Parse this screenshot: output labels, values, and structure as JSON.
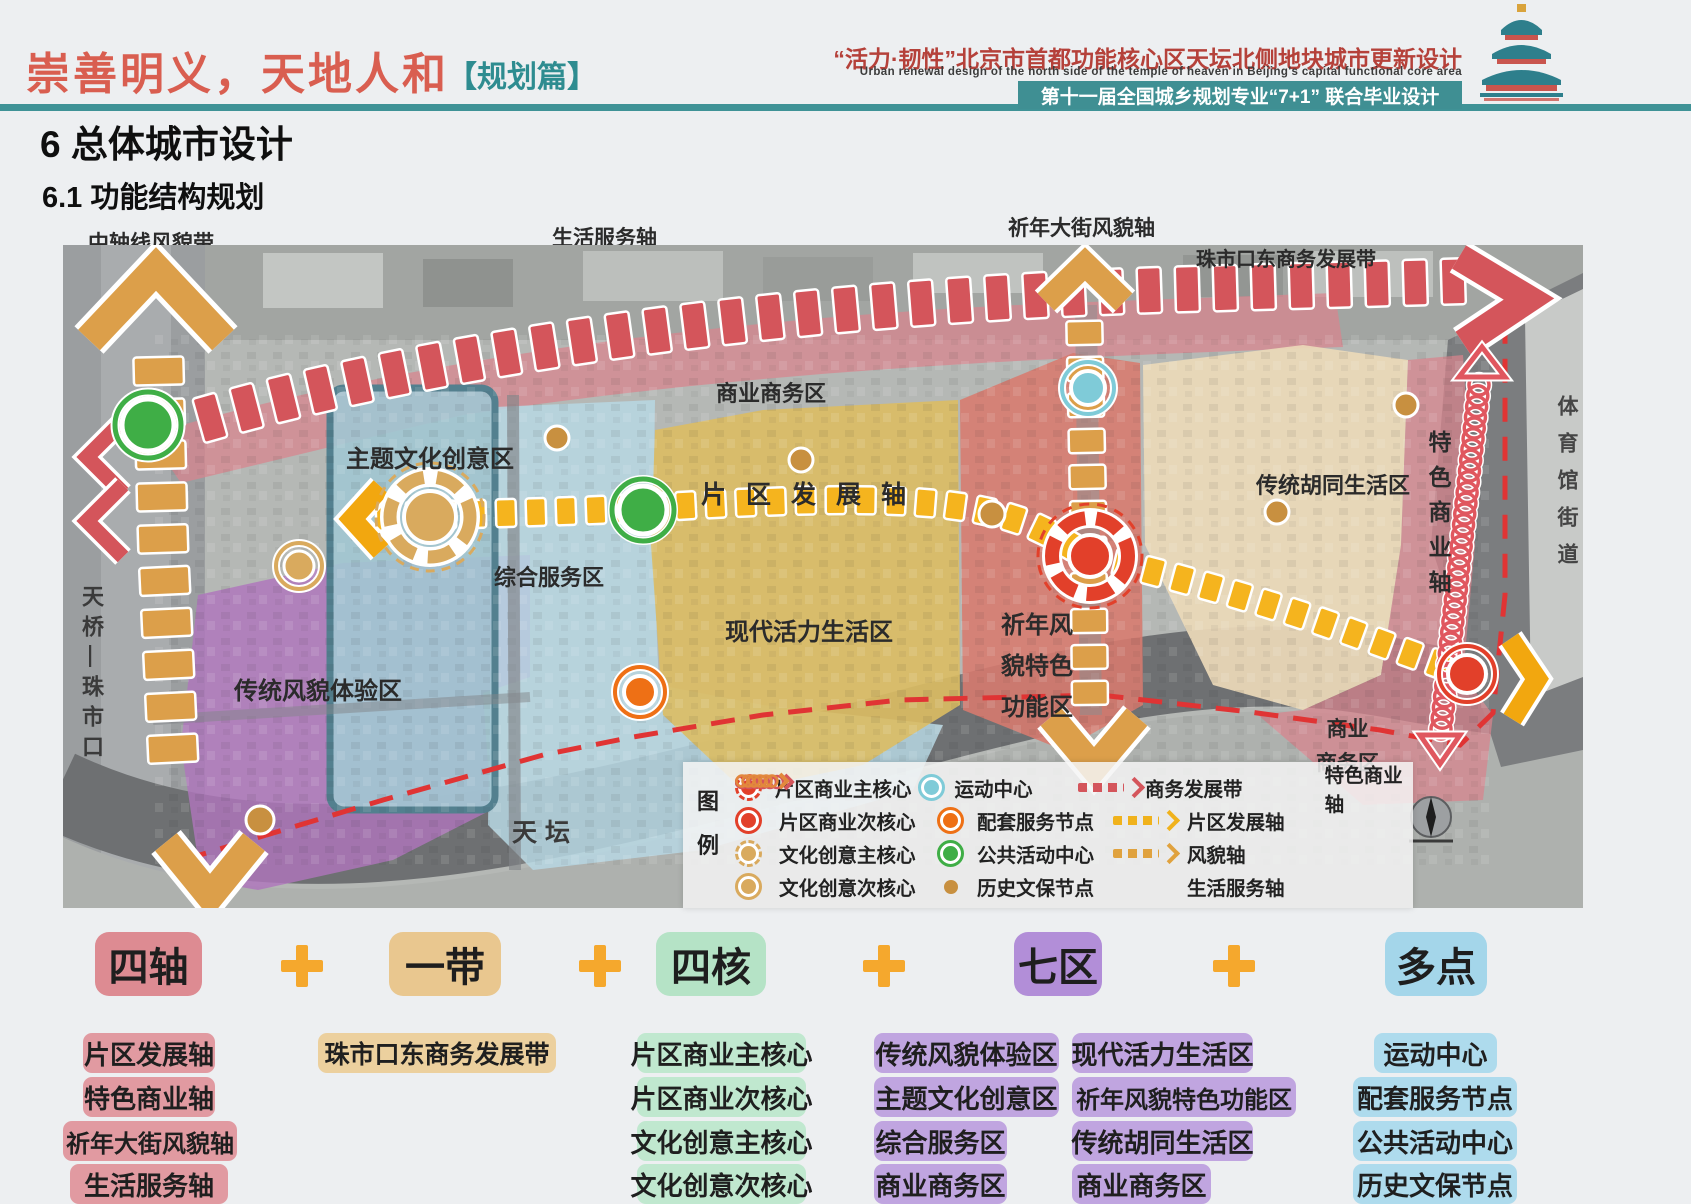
{
  "header": {
    "motto": "崇善明义，天地人和",
    "tag": "【规划篇】",
    "title_cn": "“活力·韧性”北京市首都功能核心区天坛北侧地块城市更新设计",
    "title_en": "Urban renewal design of the north side of the temple of heaven in Beijing's capital functional core area",
    "banner": "第十一届全国城乡规划专业“7+1”  联合毕业设计"
  },
  "titles": {
    "chapter": "6 总体城市设计",
    "section": "6.1 功能结构规划"
  },
  "map": {
    "top_labels": {
      "central_axis": "中轴线风貌带",
      "life_service": "生活服务轴",
      "qinian_street": "祈年大街风貌轴",
      "zhushikou": "珠市口东商务发展带"
    },
    "zones": {
      "business_top": "商业商务区",
      "theme_culture": "主题文化创意区",
      "composite_service": "综合服务区",
      "traditional_style": "传统风貌体验区",
      "modern_life": "现代活力生活区",
      "qinian_feature": "祈年风\n貌特色\n功能区",
      "hutong_life": "传统胡同生活区",
      "business_se": "商业\n商务区"
    },
    "axes": {
      "development": "片区发展轴",
      "special_business": "特色商业轴"
    },
    "streets": {
      "tianqiao": "天桥—珠市口",
      "tiantan": "天坛",
      "gymnasium": "体育馆街道"
    }
  },
  "legend": {
    "title": "图\n例",
    "rows": [
      {
        "col1": "片区商业主核心",
        "col2": "运动中心",
        "col3": "商务发展带",
        "col4": "特色商业轴"
      },
      {
        "col1": "片区商业次核心",
        "col2": "配套服务节点",
        "col3": "片区发展轴",
        "col4": ""
      },
      {
        "col1": "文化创意主核心",
        "col2": "公共活动中心",
        "col3": "风貌轴",
        "col4": ""
      },
      {
        "col1": "文化创意次核心",
        "col2": "历史文保节点",
        "col3": "生活服务轴",
        "col4": ""
      }
    ]
  },
  "summary": {
    "groups": [
      {
        "label": "四轴",
        "items": [
          "片区发展轴",
          "特色商业轴",
          "祈年大街风貌轴",
          "生活服务轴"
        ]
      },
      {
        "label": "一带",
        "items": [
          "珠市口东商务发展带"
        ]
      },
      {
        "label": "四核",
        "items": [
          "片区商业主核心",
          "片区商业次核心",
          "文化创意主核心",
          "文化创意次核心"
        ]
      },
      {
        "label": "七区",
        "items_col1": [
          "传统风貌体验区",
          "主题文化创意区",
          "综合服务区",
          "商业商务区"
        ],
        "items_col2": [
          "现代活力生活区",
          "祈年风貌特色功能区",
          "传统胡同生活区",
          "商业商务区"
        ]
      },
      {
        "label": "多点",
        "items": [
          "运动中心",
          "配套服务节点",
          "公共活动中心",
          "历史文保节点"
        ]
      }
    ]
  },
  "colors": {
    "accent_red": "#d95e50",
    "teal": "#3f8f93",
    "axis_orange": "#dc9f4a",
    "axis_yellow": "#f5b41e",
    "band_red": "#d4555b",
    "node_red": "#e2402a",
    "node_green": "#3fae46",
    "node_cyan": "#7fcbd8",
    "node_orange": "#ee7015",
    "node_tan": "#d9aa5e"
  }
}
